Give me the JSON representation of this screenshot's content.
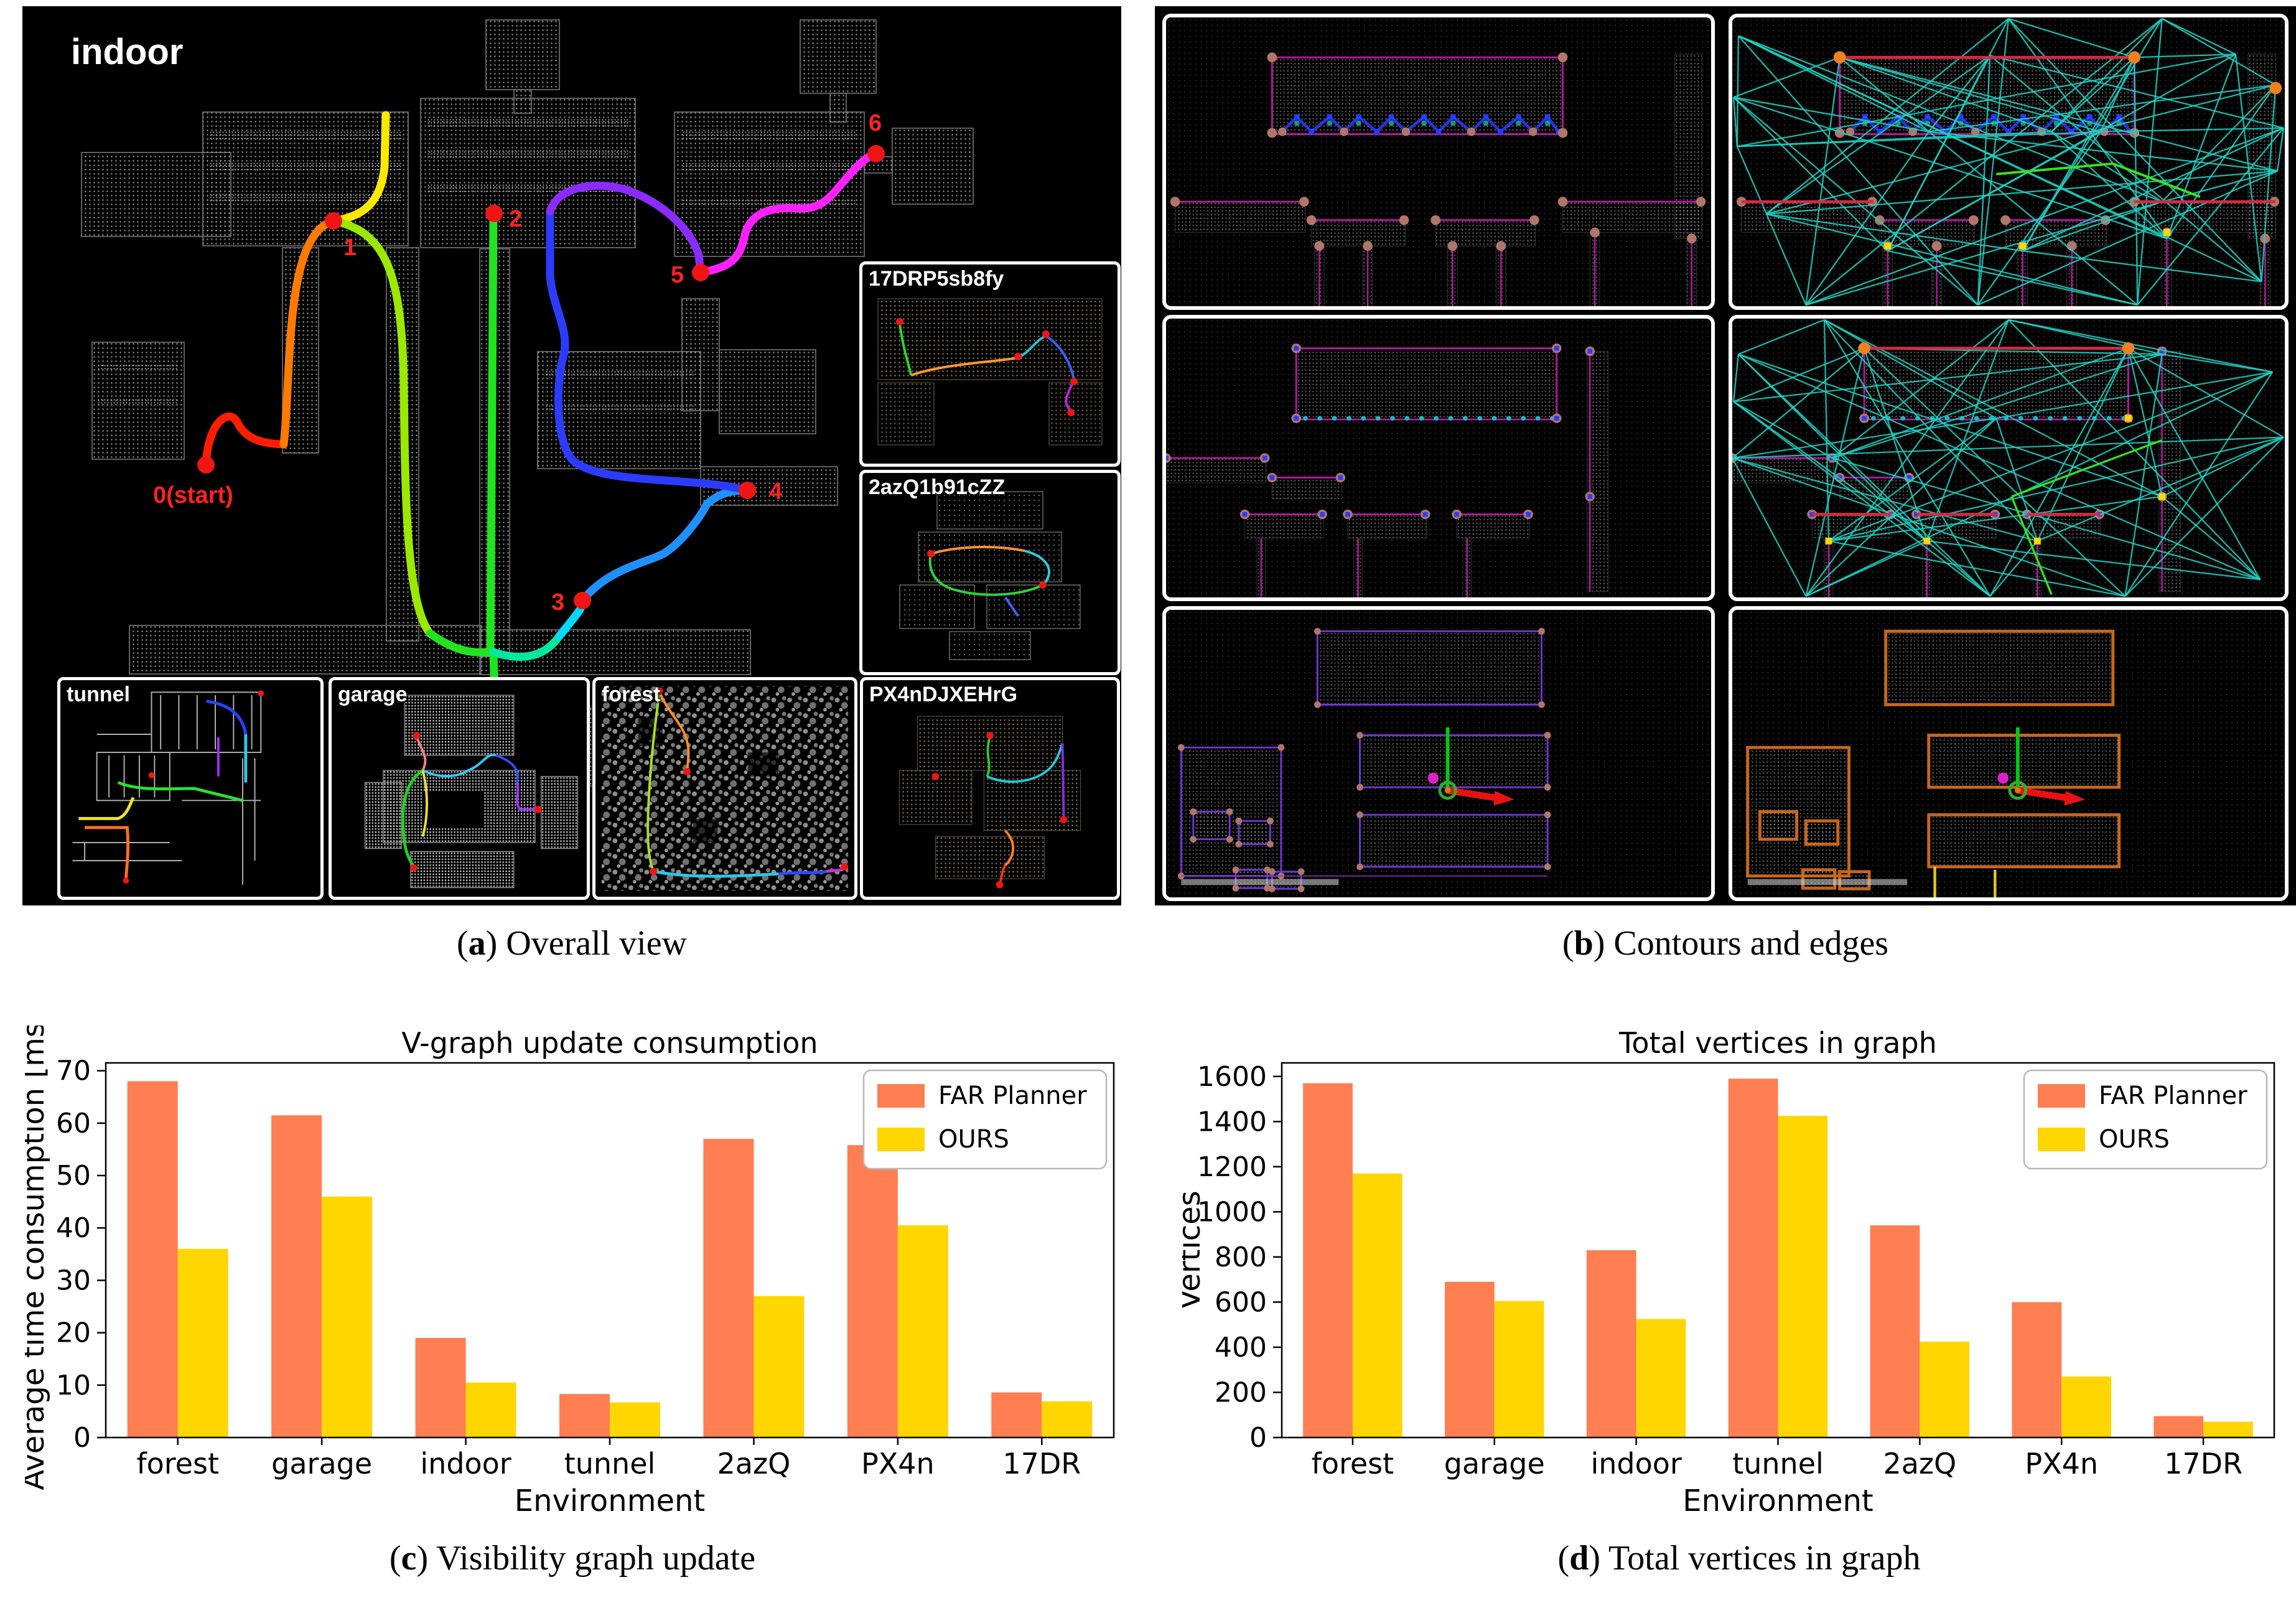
{
  "captions": {
    "a": {
      "open": "(",
      "letter": "a",
      "close": ") ",
      "text": "Overall view"
    },
    "b": {
      "open": "(",
      "letter": "b",
      "close": ") ",
      "text": "Contours and edges"
    },
    "c": {
      "open": "(",
      "letter": "c",
      "close": ") ",
      "text": "Visibility graph update"
    },
    "d": {
      "open": "(",
      "letter": "d",
      "close": ") ",
      "text": "Total vertices in graph"
    }
  },
  "panel_a": {
    "main_label": "indoor",
    "waypoints": [
      {
        "label": "0(start)"
      },
      {
        "label": "1"
      },
      {
        "label": "2"
      },
      {
        "label": "3"
      },
      {
        "label": "4"
      },
      {
        "label": "5"
      },
      {
        "label": "6"
      }
    ],
    "insets": [
      {
        "label": "17DRP5sb8fy"
      },
      {
        "label": "2azQ1b91cZZ"
      },
      {
        "label": "tunnel"
      },
      {
        "label": "garage"
      },
      {
        "label": "forest"
      },
      {
        "label": "PX4nDJXEHrG"
      }
    ],
    "trajectory_colors": [
      "#ff1e00",
      "#ff7a00",
      "#ffe800",
      "#9be800",
      "#21e421",
      "#00e8a0",
      "#00d9ff",
      "#1e90ff",
      "#2b3cff",
      "#8a2bff",
      "#ff20ff"
    ]
  },
  "colors": {
    "far_planner": "#FF7E52",
    "ours": "#FFD600",
    "edge_cyan": "#1ed3c3",
    "contour_magenta": "#b5179e",
    "contour_orange": "#c8661a",
    "waypoint_red": "#ff2222"
  },
  "chart_data": [
    {
      "type": "bar",
      "title": "V-graph update consumption",
      "xlabel": "Environment",
      "ylabel": "Average time consumption [ms]",
      "categories": [
        "forest",
        "garage",
        "indoor",
        "tunnel",
        "2azQ",
        "PX4n",
        "17DR"
      ],
      "series": [
        {
          "name": "FAR Planner",
          "color": "#FF7E52",
          "values": [
            68,
            61.5,
            19,
            8.3,
            57,
            55.8,
            8.6
          ]
        },
        {
          "name": "OURS",
          "color": "#FFD600",
          "values": [
            36,
            46,
            10.5,
            6.7,
            27,
            40.5,
            6.9
          ]
        }
      ],
      "ylim": [
        0,
        71.5
      ],
      "yticks": [
        0,
        10,
        20,
        30,
        40,
        50,
        60,
        70
      ],
      "legend": {
        "position": "upper right"
      },
      "grid": false
    },
    {
      "type": "bar",
      "title": "Total vertices in graph",
      "xlabel": "Environment",
      "ylabel": "Vertices",
      "categories": [
        "forest",
        "garage",
        "indoor",
        "tunnel",
        "2azQ",
        "PX4n",
        "17DR"
      ],
      "series": [
        {
          "name": "FAR Planner",
          "color": "#FF7E52",
          "values": [
            1570,
            690,
            830,
            1590,
            940,
            600,
            95
          ]
        },
        {
          "name": "OURS",
          "color": "#FFD600",
          "values": [
            1170,
            605,
            525,
            1425,
            425,
            270,
            70
          ]
        }
      ],
      "ylim": [
        0,
        1660
      ],
      "yticks": [
        0,
        200,
        400,
        600,
        800,
        1000,
        1200,
        1400,
        1600
      ],
      "legend": {
        "position": "upper right"
      },
      "grid": false
    }
  ]
}
